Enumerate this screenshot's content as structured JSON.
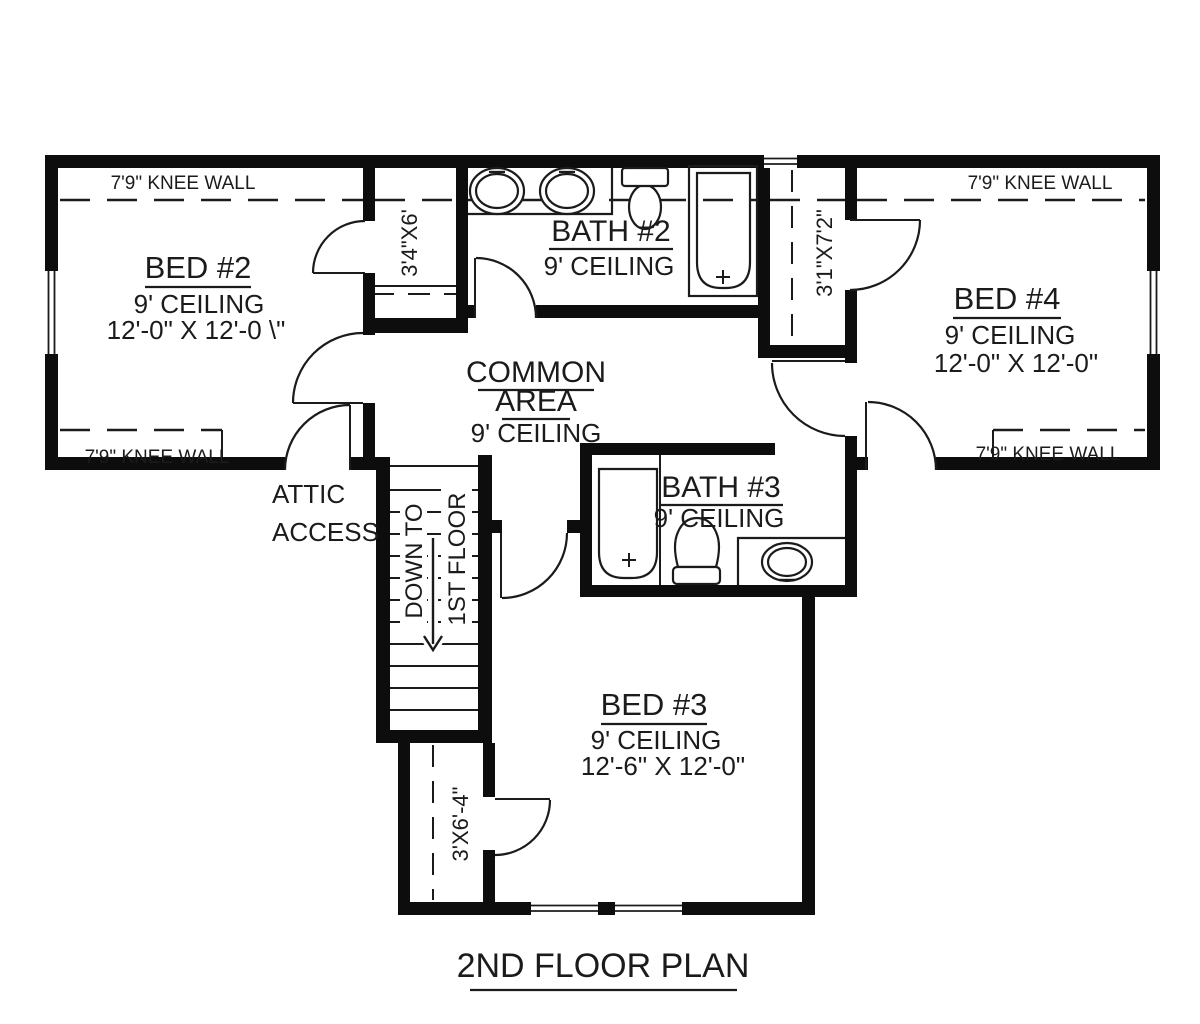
{
  "plan": {
    "title": "2ND FLOOR PLAN",
    "knee_wall_label": "7'9\" KNEE WALL",
    "rooms": {
      "bed2": {
        "name": "BED #2",
        "ceiling": "9' CEILING",
        "dims": "12'-0\" X 12'-0 \\\""
      },
      "bath2": {
        "name": "BATH #2",
        "ceiling": "9' CEILING"
      },
      "bed4": {
        "name": "BED #4",
        "ceiling": "9' CEILING",
        "dims": "12'-0\" X 12'-0\""
      },
      "common": {
        "line1": "COMMON",
        "line2": "AREA",
        "ceiling": "9' CEILING"
      },
      "bath3": {
        "name": "BATH #3",
        "ceiling": "9' CEILING"
      },
      "bed3": {
        "name": "BED #3",
        "ceiling": "9' CEILING",
        "dims": "12'-6\" X 12'-0\""
      }
    },
    "closets": {
      "c1": "3'4\"X6'",
      "c2": "3'1\"X7'2\"",
      "c3": "3'X6'-4\""
    },
    "attic": {
      "line1": "ATTIC",
      "line2": "ACCESS"
    },
    "stairs": {
      "line1": "DOWN TO",
      "line2": "1ST FLOOR"
    }
  },
  "colors": {
    "wall": "#0d0d0d",
    "line": "#1b1b1b",
    "background": "#ffffff"
  }
}
